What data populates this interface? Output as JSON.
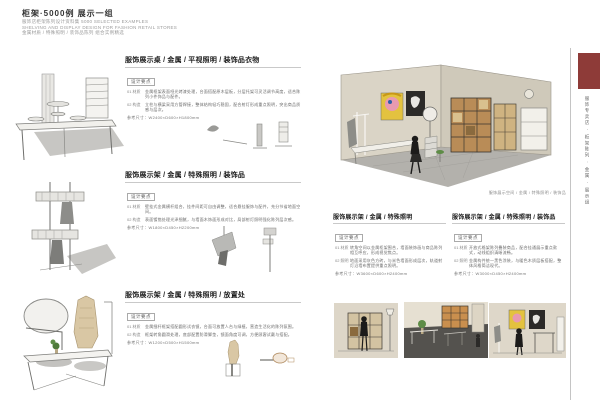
{
  "header": {
    "title": "柜架·5000例 展示一组",
    "subtitles": [
      "服饰店柜架陈列设计资料集 5000 SELECTED EXAMPLES",
      "SHELVING AND DISPLAY DESIGN FOR FASHION RETAIL STORES",
      "金属材质 / 特殊照明 / 装饰品陈列 组合实例精选"
    ]
  },
  "sidebar": {
    "tab_color": "#8e3b38",
    "vertical_label": "服饰专卖店 · 柜架陈列 · 金属 · 展示组"
  },
  "perspective_caption": "服饰展示空间 / 金属 / 特殊照明 / 装饰品",
  "left_sections": [
    {
      "heading": "服饰展示桌 / 金属 / 平视照明 / 装饰品衣物",
      "tag": "设计要点",
      "specs": [
        {
          "label": "01 材质",
          "text": "金属框架表面哑光烤漆处理，台面搭配原木层板，分层托架可灵活调节高度，适合陈列小件饰品与配件。"
        },
        {
          "label": "02 构造",
          "text": "立柱与横梁采用方管焊接，整体结构轻巧稳固，配合射灯形成重点照明，突出商品质感与层次。"
        }
      ],
      "dimension": "参考尺寸：W2400×D600×H1800mm"
    },
    {
      "heading": "服饰展示架 / 金属 / 特殊照明 / 装饰品",
      "tag": "设计要点",
      "specs": [
        {
          "label": "01 材质",
          "text": "壁挂式金属横杆组合，挂件间距可自由调整，适合悬挂服饰与配件，充分节省地面空间。"
        },
        {
          "label": "02 构造",
          "text": "表面镀铬处理光泽细腻，与墙面木饰面形成对比，局部射灯照明强化陈列层次感。"
        }
      ],
      "dimension": "参考尺寸：W1800×D450×H2200mm"
    },
    {
      "heading": "服饰展示架 / 金属 / 特殊照明 / 放置处",
      "tag": "设计要点",
      "specs": [
        {
          "label": "01 材质",
          "text": "金属细杆框架搭配圆形试衣镜，台面可放置人台与绿植，营造生活化的陈列氛围。"
        },
        {
          "label": "02 构造",
          "text": "框架转角圆滑处理，底部配置防滑脚垫，镜面角度可调，方便顾客试戴与搭配。"
        }
      ],
      "dimension": "参考尺寸：W1200×D500×H1500mm"
    }
  ],
  "right_blocks": [
    {
      "heading": "服饰展示架 / 金属 / 特殊照明",
      "tag": "设计要点",
      "specs": [
        {
          "label": "01 材质",
          "text": "转角空间以金属柜架围合，墙面装饰画与商品陈列相互呼应，形成视觉焦点。"
        },
        {
          "label": "02 照明",
          "text": "地面采用灰色方砖，与米色墙面形成层次，轨道射灯沿墙布置提供重点照明。"
        }
      ],
      "dimension": "参考尺寸：W3600×D600×H2400mm"
    },
    {
      "heading": "服饰展示架 / 金属 / 特殊照明 / 装饰品",
      "tag": "设计要点",
      "specs": [
        {
          "label": "01 材质",
          "text": "开放式格架陈列叠装商品，配合挂通展示重点款式，动线组织清晰流畅。"
        },
        {
          "label": "02 照明",
          "text": "金属构件统一黑色涂装，与暖色木质层板搭配，整体风格简洁现代。"
        }
      ],
      "dimension": "参考尺寸：W3000×D450×H2400mm"
    }
  ]
}
